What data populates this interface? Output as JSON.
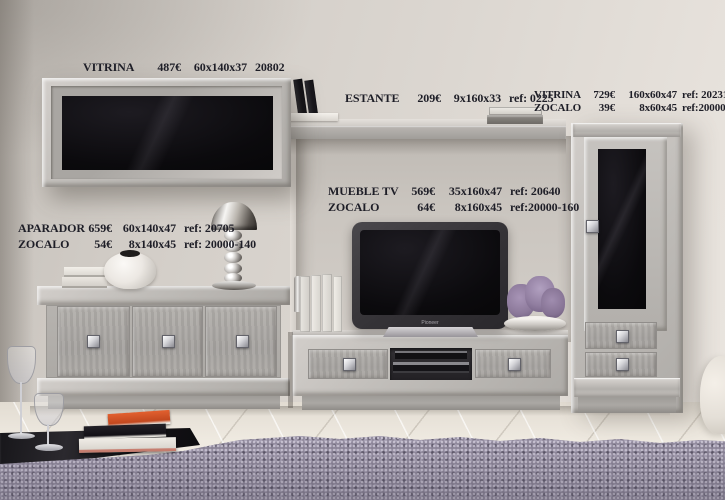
{
  "scene_description": "Living room wall-unit furniture catalog photo with price annotations",
  "annotations": {
    "wall_vitrina": {
      "name": "VITRINA",
      "price": "487€",
      "dims": "60x140x37",
      "ref": "20802"
    },
    "estante": {
      "name": "ESTANTE",
      "price": "209€",
      "dims": "9x160x33",
      "ref": "ref: 0225"
    },
    "tall_vitrina": {
      "name": "VITRINA",
      "price": "729€",
      "dims": "160x60x47",
      "ref": "ref: 20231"
    },
    "tall_vitrina_zocalo": {
      "name": "ZOCALO",
      "price": "39€",
      "dims": "8x60x45",
      "ref": "ref:20000-60"
    },
    "aparador": {
      "name": "APARADOR",
      "price": "659€",
      "dims": "60x140x47",
      "ref": "ref: 20705"
    },
    "aparador_zocalo": {
      "name": "ZOCALO",
      "price": "54€",
      "dims": "8x140x45",
      "ref": "ref: 20000-140"
    },
    "mueble_tv": {
      "name": "MUEBLE TV",
      "price": "569€",
      "dims": "35x160x47",
      "ref": "ref: 20640"
    },
    "mueble_tv_zocalo": {
      "name": "ZOCALO",
      "price": "64€",
      "dims": "8x160x45",
      "ref": "ref:20000-160"
    }
  },
  "tv": {
    "brand": "Pioneer"
  },
  "colors": {
    "wall": "#d8d3cd",
    "furniture_gray": "#b7b4b0",
    "glass_black": "#0b0a0c",
    "floor": "#efeae1",
    "rug_purple": "#918a9d",
    "table_black": "#151317",
    "annotation_text": "#1e1e27",
    "lavender": "#8d7a9b",
    "chrome": "#d3d3d7"
  }
}
